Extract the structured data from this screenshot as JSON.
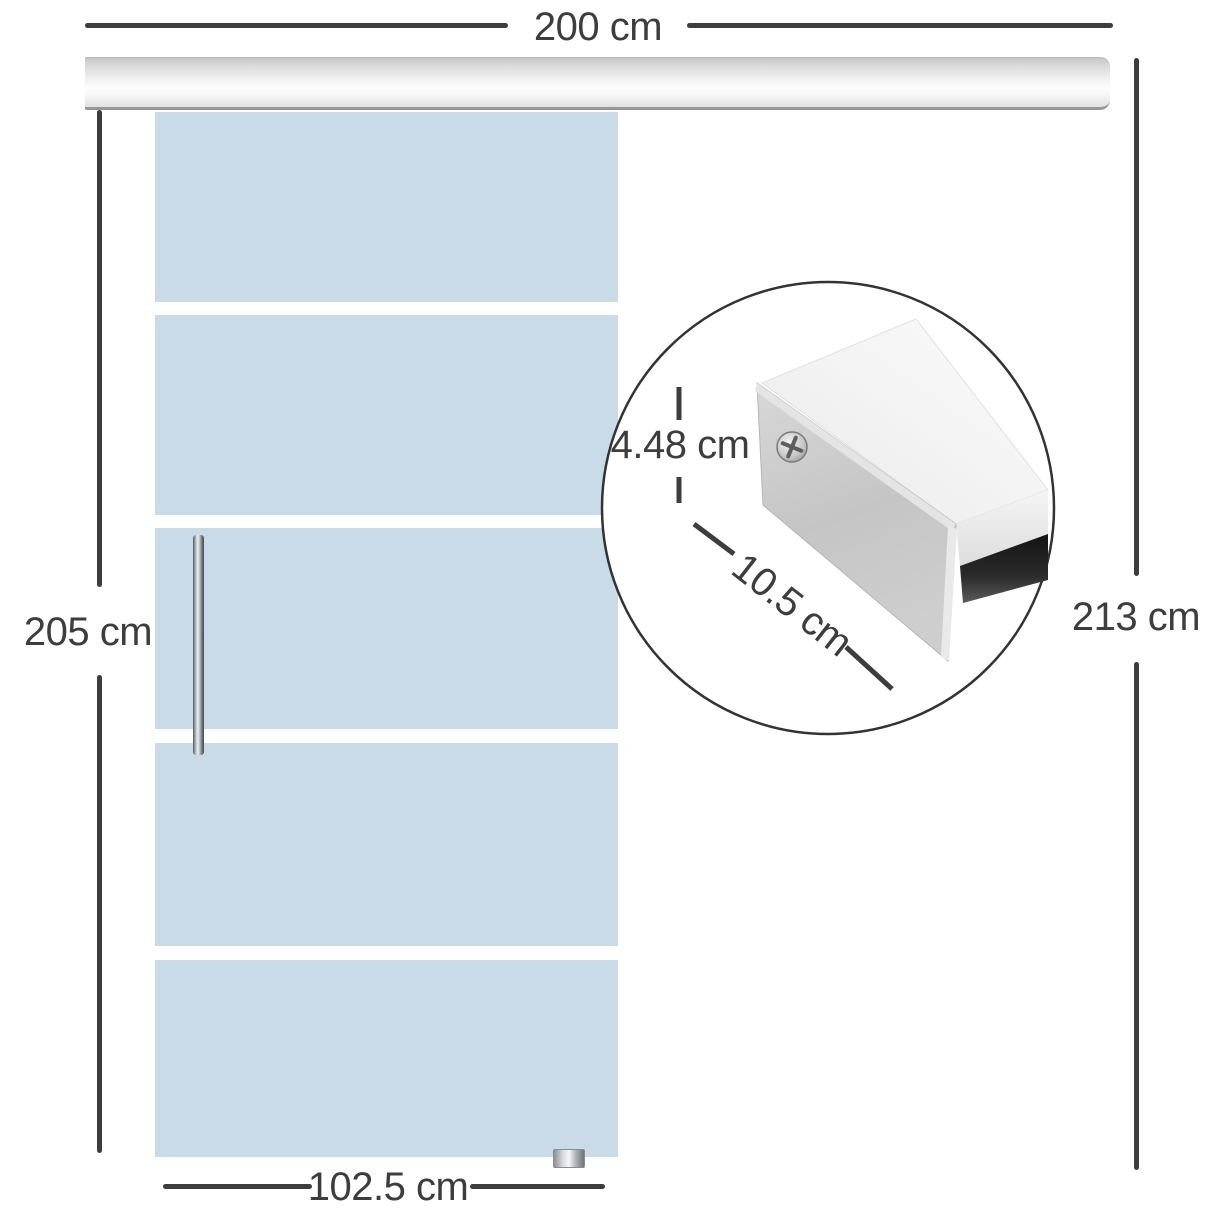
{
  "diagram": {
    "type": "product-dimension-diagram",
    "subject": "sliding glass door with overhead track rail and end-cap detail inset",
    "glass_panel_count": 5,
    "labels": {
      "track_width": "200 cm",
      "door_height": "205 cm",
      "total_height": "213 cm",
      "door_width": "102.5 cm",
      "detail_height": "4.48 cm",
      "detail_depth": "10.5 cm"
    },
    "colors": {
      "glass": "#c9dbe6",
      "dimension_lines": "#3d3d3d",
      "track_metal": "#e9e9e9",
      "track_bottom_edge": "#979797",
      "background": "#ffffff"
    }
  }
}
